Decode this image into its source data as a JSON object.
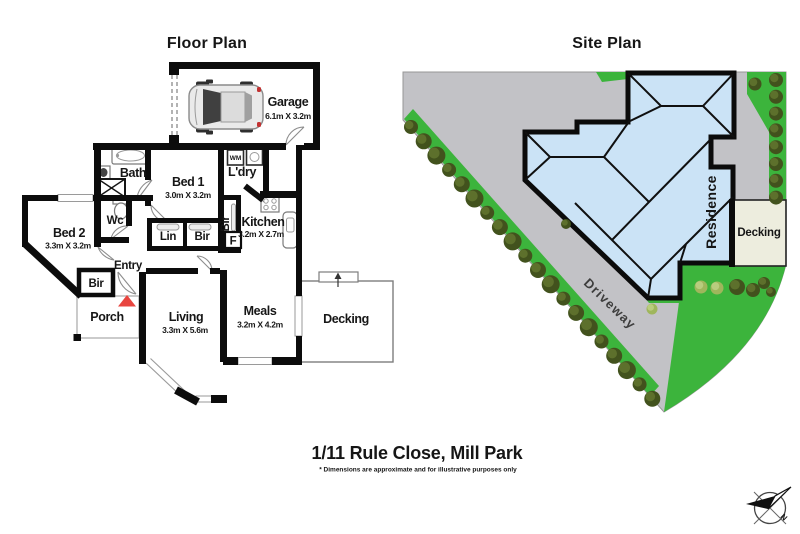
{
  "floor_plan": {
    "title": "Floor Plan",
    "rooms": {
      "garage": {
        "label": "Garage",
        "dims": "6.1m X 3.2m"
      },
      "bath": {
        "label": "Bath"
      },
      "bed1": {
        "label": "Bed 1",
        "dims": "3.0m X 3.2m"
      },
      "laundry": {
        "label": "L'dry"
      },
      "washing_machine": {
        "label": "WM"
      },
      "wc": {
        "label": "Wc"
      },
      "linen": {
        "label": "Lin"
      },
      "bir_hall": {
        "label": "Bir"
      },
      "bir_bed1": {
        "label": "Bir"
      },
      "kitchen": {
        "label": "Kitchen",
        "dims": "3.2m X 2.7m"
      },
      "fridge": {
        "label": "F"
      },
      "bed2": {
        "label": "Bed 2",
        "dims": "3.3m X 3.2m"
      },
      "bir_bed2": {
        "label": "Bir"
      },
      "entry": {
        "label": "Entry"
      },
      "porch": {
        "label": "Porch"
      },
      "living": {
        "label": "Living",
        "dims": "3.3m X 5.6m"
      },
      "meals": {
        "label": "Meals",
        "dims": "3.2m X 4.2m"
      },
      "decking": {
        "label": "Decking"
      }
    }
  },
  "site_plan": {
    "title": "Site Plan",
    "labels": {
      "residence": "Residence",
      "decking": "Decking",
      "driveway": "Driveway"
    }
  },
  "footer": {
    "address": "1/11 Rule Close, Mill Park",
    "disclaimer": "* Dimensions are approximate and for illustrative purposes only"
  },
  "compass": {
    "north_label": "N"
  },
  "colors": {
    "wall": "#0c0c0c",
    "roof": "#CBE3F6",
    "grass": "#3CB43C",
    "driveway": "#C2C2C6",
    "site_decking": "#EDEDDE",
    "tree_dark": "#42521D",
    "tree_mid": "#5D702C",
    "bush_light": "#9FB65C",
    "bush_light_hi": "#B9CC7E",
    "arrow_red": "#E8453F"
  },
  "icons": {
    "car": "car-top-view-icon",
    "compass": "compass-rose-icon",
    "tree": "tree-icon",
    "bathtub": "bathtub-icon",
    "toilet": "toilet-icon",
    "shower": "shower-icon",
    "sink": "sink-icon",
    "stove": "stove-icon",
    "washing_machine": "washing-machine-icon",
    "laundry_trough": "laundry-trough-icon",
    "entry_arrow": "entry-arrow-icon"
  }
}
